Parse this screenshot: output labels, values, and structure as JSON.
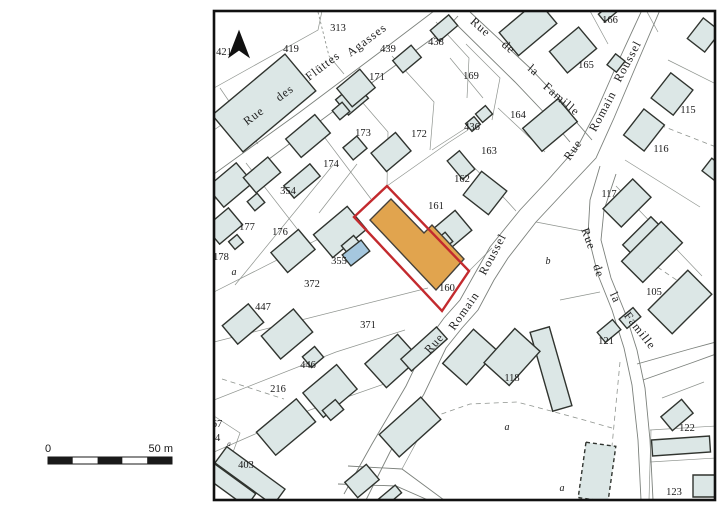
{
  "map": {
    "highlighted_parcel": "160",
    "colors": {
      "building_fill": "#dce7e6",
      "building_stroke": "#30342f",
      "highlight_fill": "#e1a44e",
      "highlight_stroke": "#44403a",
      "parcel_outline_red": "#c32a2e",
      "pool_fill": "#a5c7de",
      "border": "#111111"
    },
    "streets": [
      {
        "name": "Rue des Flüttes Agasses",
        "words": [
          {
            "t": "Rue",
            "x": 256,
            "y": 119,
            "r": -37
          },
          {
            "t": "des",
            "x": 287,
            "y": 96,
            "r": -37
          },
          {
            "t": "Flüttes",
            "x": 325,
            "y": 69,
            "r": -37
          },
          {
            "t": "Agasses",
            "x": 369,
            "y": 43,
            "r": -37
          }
        ]
      },
      {
        "name": "Rue de la Famille",
        "words": [
          {
            "t": "Rue",
            "x": 478,
            "y": 30,
            "r": 41
          },
          {
            "t": "de",
            "x": 506,
            "y": 50,
            "r": 41
          },
          {
            "t": "la",
            "x": 531,
            "y": 73,
            "r": 41
          },
          {
            "t": "Famille",
            "x": 559,
            "y": 102,
            "r": 41
          }
        ]
      },
      {
        "name": "Rue Romain Roussel",
        "words": [
          {
            "t": "Rue",
            "x": 576,
            "y": 152,
            "r": -55
          },
          {
            "t": "Romain",
            "x": 606,
            "y": 113,
            "r": -62
          },
          {
            "t": "Roussel",
            "x": 631,
            "y": 63,
            "r": -62
          }
        ]
      },
      {
        "name": "Rue Romain Roussel",
        "words": [
          {
            "t": "Rue",
            "x": 437,
            "y": 346,
            "r": -48
          },
          {
            "t": "Romain",
            "x": 467,
            "y": 313,
            "r": -55
          },
          {
            "t": "Roussel",
            "x": 496,
            "y": 256,
            "r": -62
          }
        ]
      },
      {
        "name": "Rue de la Famille",
        "words": [
          {
            "t": "Rue",
            "x": 585,
            "y": 240,
            "r": 70
          },
          {
            "t": "de",
            "x": 595,
            "y": 272,
            "r": 72
          },
          {
            "t": "la",
            "x": 612,
            "y": 299,
            "r": 65
          },
          {
            "t": "Famille",
            "x": 637,
            "y": 333,
            "r": 52
          }
        ]
      }
    ],
    "parcel_labels": [
      {
        "t": "313",
        "x": 338,
        "y": 31
      },
      {
        "t": "419",
        "x": 291,
        "y": 52
      },
      {
        "t": "421",
        "x": 224,
        "y": 55
      },
      {
        "t": "439",
        "x": 388,
        "y": 52
      },
      {
        "t": "438",
        "x": 436,
        "y": 45
      },
      {
        "t": "166",
        "x": 610,
        "y": 23
      },
      {
        "t": "171",
        "x": 377,
        "y": 80
      },
      {
        "t": "169",
        "x": 471,
        "y": 79
      },
      {
        "t": "165",
        "x": 586,
        "y": 68
      },
      {
        "t": "173",
        "x": 363,
        "y": 136
      },
      {
        "t": "172",
        "x": 419,
        "y": 137
      },
      {
        "t": "436",
        "x": 472,
        "y": 130
      },
      {
        "t": "164",
        "x": 518,
        "y": 118
      },
      {
        "t": "115",
        "x": 688,
        "y": 113
      },
      {
        "t": "163",
        "x": 489,
        "y": 154
      },
      {
        "t": "116",
        "x": 661,
        "y": 152
      },
      {
        "t": "174",
        "x": 331,
        "y": 167
      },
      {
        "t": "162",
        "x": 462,
        "y": 182
      },
      {
        "t": "354",
        "x": 288,
        "y": 194
      },
      {
        "t": "161",
        "x": 436,
        "y": 209
      },
      {
        "t": "117",
        "x": 609,
        "y": 197
      },
      {
        "t": "177",
        "x": 247,
        "y": 230
      },
      {
        "t": "176",
        "x": 280,
        "y": 235
      },
      {
        "t": "178",
        "x": 221,
        "y": 260
      },
      {
        "t": "355",
        "x": 339,
        "y": 264
      },
      {
        "t": "105",
        "x": 654,
        "y": 295
      },
      {
        "t": "372",
        "x": 312,
        "y": 287
      },
      {
        "t": "160",
        "x": 447,
        "y": 291
      },
      {
        "t": "447",
        "x": 263,
        "y": 310
      },
      {
        "t": "371",
        "x": 368,
        "y": 328
      },
      {
        "t": "121",
        "x": 606,
        "y": 344
      },
      {
        "t": "446",
        "x": 308,
        "y": 368
      },
      {
        "t": "216",
        "x": 278,
        "y": 392
      },
      {
        "t": "118",
        "x": 512,
        "y": 381
      },
      {
        "t": "403",
        "x": 246,
        "y": 468
      },
      {
        "t": "122",
        "x": 687,
        "y": 431
      },
      {
        "t": "123",
        "x": 674,
        "y": 495
      },
      {
        "t": "67",
        "x": 217,
        "y": 427
      },
      {
        "t": "04",
        "x": 215,
        "y": 441
      },
      {
        "t": "a",
        "x": 234,
        "y": 275,
        "style": "it"
      },
      {
        "t": "b",
        "x": 548,
        "y": 264,
        "style": "it"
      },
      {
        "t": "a",
        "x": 507,
        "y": 430,
        "style": "it"
      },
      {
        "t": "a",
        "x": 562,
        "y": 491,
        "style": "it"
      },
      {
        "t": "a",
        "x": 229,
        "y": 446,
        "style": "it tiny"
      }
    ]
  },
  "scale_bar": {
    "start_label": "0",
    "end_label": "50 m"
  }
}
